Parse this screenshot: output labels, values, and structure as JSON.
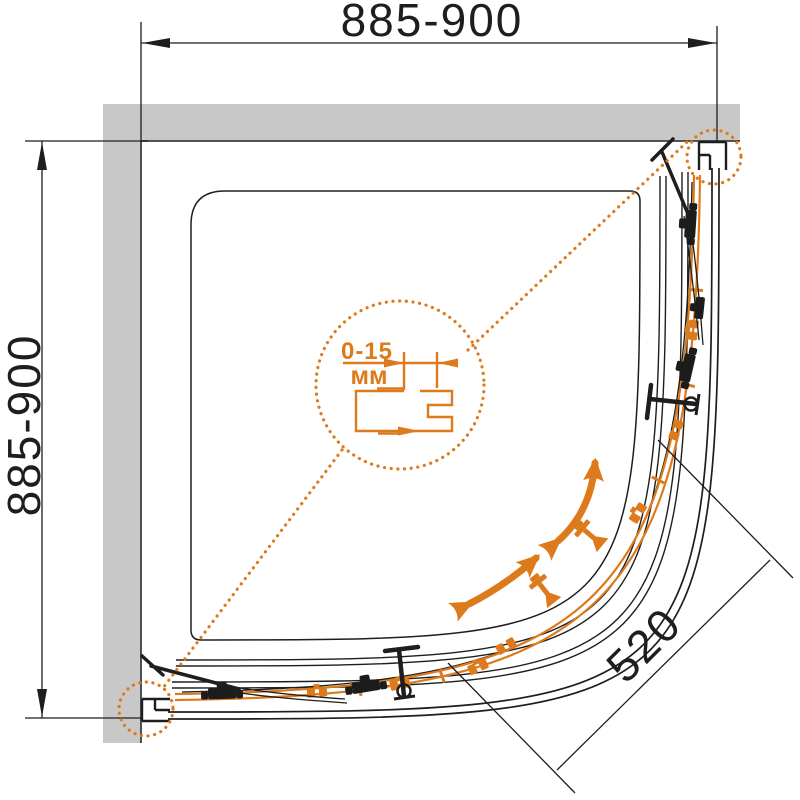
{
  "drawing": {
    "subject": "quarter-round shower enclosure plan view",
    "dimension_top": "885-900",
    "dimension_left": "885-900",
    "dimension_door": "520",
    "detail_range": "0-15",
    "detail_unit": "мм"
  },
  "colors": {
    "accent": "#dd7b1c",
    "wall": "#c8c8c8",
    "line": "#1e1e1e"
  }
}
